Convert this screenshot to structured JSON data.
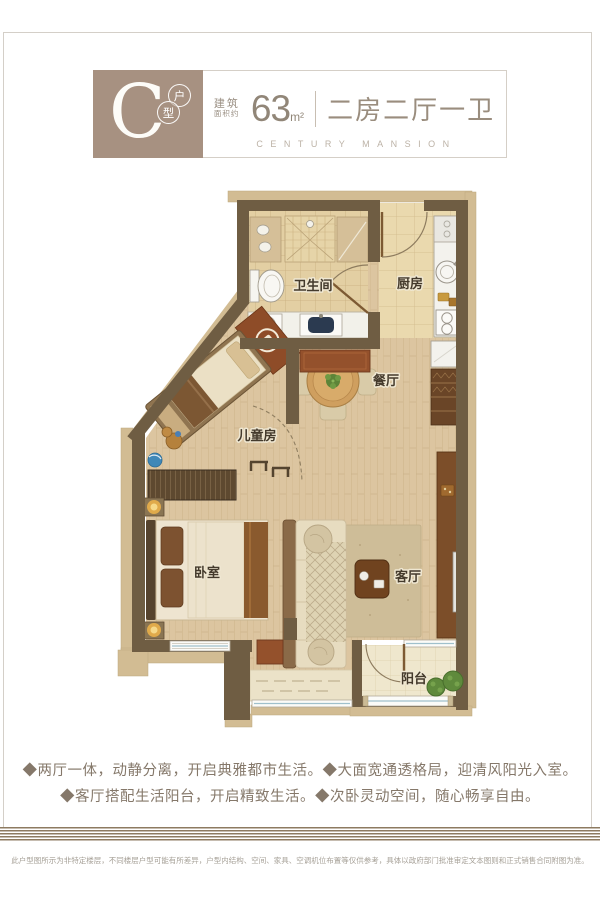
{
  "header": {
    "unit_letter": "C",
    "unit_type_char1": "户",
    "unit_type_char2": "型",
    "area_label_line1": "建筑",
    "area_label_line2": "面积约",
    "area_value": "63",
    "area_unit": "m²",
    "layout_title": "二房二厅一卫",
    "subtitle_en": "CENTURY MANSION"
  },
  "plan": {
    "rooms": {
      "bathroom": "卫生间",
      "kitchen": "厨房",
      "dining": "餐厅",
      "kids_room": "儿童房",
      "bedroom": "卧室",
      "living": "客厅",
      "balcony": "阳台"
    }
  },
  "features": {
    "line1": "◆两厅一体，动静分离，开启典雅都市生活。◆大面宽通透格局，迎清风阳光入室。",
    "line2": "◆客厅搭配生活阳台，开启精致生活。◆次卧灵动空间，随心畅享自由。"
  },
  "disclaimer": "此户型图所示为非特定楼层，不同楼层户型可能有所差异，户型内结构、空间、家具、空调机位布置等仅供参考，具体以政府部门批准审定文本图则和正式销售合同附图为准。",
  "colors": {
    "brand_brown": "#a79181",
    "wall_brown": "#6f5d43",
    "accent_red": "#94512c",
    "wood_floor": "#dcc5a0"
  }
}
